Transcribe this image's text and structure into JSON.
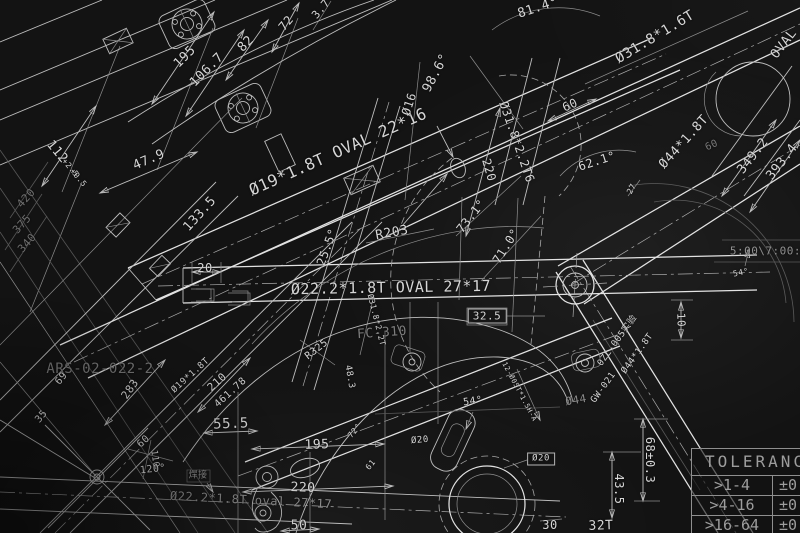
{
  "colors": {
    "background": "#131313",
    "line": "#bdbdbd",
    "line_bright": "#e2e2e2",
    "line_faint": "#575757",
    "text": "#d6d6d6",
    "text_faint": "#8d8d8d"
  },
  "table": {
    "header": "TOLERANCE",
    "rows": [
      {
        "range": ">1-4",
        "value": "±0"
      },
      {
        "range": ">4-16",
        "value": "±0"
      },
      {
        "range": ">16-64",
        "value": "±0"
      }
    ]
  },
  "drawing": {
    "labels": [
      {
        "name": "dim-label",
        "text": "195",
        "x": 185,
        "y": 57,
        "rot": -45,
        "size": 13
      },
      {
        "name": "dim-label",
        "text": "106.7",
        "x": 207,
        "y": 70,
        "rot": -45,
        "size": 13
      },
      {
        "name": "dim-label",
        "text": "82",
        "x": 246,
        "y": 44,
        "rot": -45,
        "size": 13
      },
      {
        "name": "dim-label",
        "text": "112",
        "x": 57,
        "y": 152,
        "rot": 50,
        "size": 13
      },
      {
        "name": "tolerance-label",
        "text": "+2.5",
        "x": 70,
        "y": 168,
        "rot": 50,
        "size": 8
      },
      {
        "name": "tolerance-label",
        "text": "+0.5",
        "x": 78,
        "y": 178,
        "rot": 50,
        "size": 8
      },
      {
        "name": "dim-label",
        "text": "47.9",
        "x": 149,
        "y": 160,
        "rot": -23,
        "size": 13
      },
      {
        "name": "dim-label",
        "text": "72",
        "x": 286,
        "y": 23,
        "rot": -50,
        "size": 12
      },
      {
        "name": "dim-label",
        "text": "3.7",
        "x": 321,
        "y": 9,
        "rot": -50,
        "size": 11
      },
      {
        "name": "dim-label",
        "text": "420",
        "x": 26,
        "y": 198,
        "rot": -48,
        "size": 11,
        "color": "#6e6e6e"
      },
      {
        "name": "dim-label",
        "text": "375",
        "x": 22,
        "y": 224,
        "rot": -48,
        "size": 11,
        "color": "#6e6e6e"
      },
      {
        "name": "dim-label",
        "text": "340",
        "x": 27,
        "y": 243,
        "rot": -48,
        "size": 11,
        "color": "#6e6e6e"
      },
      {
        "name": "dim-label",
        "text": "133.5",
        "x": 200,
        "y": 214,
        "rot": -48,
        "size": 13
      },
      {
        "name": "dim-label",
        "text": "20",
        "x": 205,
        "y": 268,
        "rot": 0,
        "size": 12
      },
      {
        "name": "tube-spec-label",
        "text": "Ø19*1.8T OVAL 22*16",
        "x": 338,
        "y": 152,
        "rot": -24,
        "size": 16
      },
      {
        "name": "dim-label",
        "text": "Ø16",
        "x": 409,
        "y": 104,
        "rot": -72,
        "size": 12
      },
      {
        "name": "angle-label",
        "text": "98.6°",
        "x": 436,
        "y": 73,
        "rot": -62,
        "size": 13
      },
      {
        "name": "tube-spec-label",
        "text": "Ø31.8*2.2T6",
        "x": 517,
        "y": 142,
        "rot": 71,
        "size": 12
      },
      {
        "name": "dim-label",
        "text": "220",
        "x": 489,
        "y": 170,
        "rot": 74,
        "size": 12
      },
      {
        "name": "angle-label",
        "text": "81.4°",
        "x": 538,
        "y": 8,
        "rot": -18,
        "size": 13
      },
      {
        "name": "tube-spec-label",
        "text": "Ø31.8*1.6T",
        "x": 655,
        "y": 37,
        "rot": -31,
        "size": 14
      },
      {
        "name": "tube-spec-label",
        "text": "OVAL",
        "x": 784,
        "y": 44,
        "rot": -52,
        "size": 13
      },
      {
        "name": "dim-label",
        "text": "60",
        "x": 570,
        "y": 105,
        "rot": -24,
        "size": 12
      },
      {
        "name": "dim-label",
        "text": "60",
        "x": 712,
        "y": 146,
        "rot": -24,
        "size": 10,
        "color": "#777777"
      },
      {
        "name": "angle-label",
        "text": "62.1°",
        "x": 597,
        "y": 161,
        "rot": -18,
        "size": 12
      },
      {
        "name": "tube-spec-label",
        "text": "Ø44*1.8T",
        "x": 684,
        "y": 142,
        "rot": -48,
        "size": 13
      },
      {
        "name": "dim-label",
        "text": "349.2",
        "x": 753,
        "y": 156,
        "rot": -52,
        "size": 13
      },
      {
        "name": "dim-label",
        "text": "393.4",
        "x": 782,
        "y": 162,
        "rot": -52,
        "size": 13
      },
      {
        "name": "angle-label",
        "text": "25.5°",
        "x": 327,
        "y": 247,
        "rot": -70,
        "size": 12
      },
      {
        "name": "radius-label",
        "text": "R203",
        "x": 392,
        "y": 233,
        "rot": -10,
        "size": 13
      },
      {
        "name": "angle-label",
        "text": "73.1°",
        "x": 471,
        "y": 216,
        "rot": -52,
        "size": 12
      },
      {
        "name": "angle-label",
        "text": "71.0°",
        "x": 506,
        "y": 246,
        "rot": -58,
        "size": 12
      },
      {
        "name": "tube-spec-label",
        "text": "Ø22.2*1.8T OVAL 27*17",
        "x": 391,
        "y": 288,
        "rot": -1,
        "size": 15
      },
      {
        "name": "dim-label",
        "text": "32.5",
        "x": 487,
        "y": 316,
        "rot": 0,
        "size": 11,
        "boxed": true
      },
      {
        "name": "part-number-label",
        "text": "FC-310",
        "x": 382,
        "y": 333,
        "rot": -4,
        "size": 13,
        "color": "#7d7d7d"
      },
      {
        "name": "tube-spec-label",
        "text": "Ø31.8*2.2T",
        "x": 376,
        "y": 320,
        "rot": 76,
        "size": 8
      },
      {
        "name": "radius-label",
        "text": "R325",
        "x": 317,
        "y": 350,
        "rot": -38,
        "size": 10
      },
      {
        "name": "note-label",
        "text": "5:00\\7:00:2",
        "x": 769,
        "y": 251,
        "rot": 0,
        "size": 11,
        "color": "#8d8d8d"
      },
      {
        "name": "part-number-label",
        "text": "ARS-02-022-2",
        "x": 100,
        "y": 369,
        "rot": 0,
        "size": 14,
        "color": "#757575"
      },
      {
        "name": "dim-label",
        "text": "69",
        "x": 62,
        "y": 379,
        "rot": -50,
        "size": 10
      },
      {
        "name": "dim-label",
        "text": "35",
        "x": 42,
        "y": 417,
        "rot": -50,
        "size": 10
      },
      {
        "name": "dim-label",
        "text": "283",
        "x": 130,
        "y": 389,
        "rot": -55,
        "size": 11
      },
      {
        "name": "tube-spec-label",
        "text": "Ø19*1.8T",
        "x": 191,
        "y": 376,
        "rot": -42,
        "size": 9
      },
      {
        "name": "dim-label",
        "text": "210",
        "x": 217,
        "y": 382,
        "rot": -42,
        "size": 11
      },
      {
        "name": "dim-label",
        "text": "461.78",
        "x": 231,
        "y": 393,
        "rot": -42,
        "size": 10
      },
      {
        "name": "dim-label",
        "text": "55.5",
        "x": 231,
        "y": 424,
        "rot": -2,
        "size": 14
      },
      {
        "name": "dim-label",
        "text": "60",
        "x": 144,
        "y": 442,
        "rot": -42,
        "size": 10
      },
      {
        "name": "dim-label",
        "text": "110",
        "x": 154,
        "y": 459,
        "rot": 82,
        "size": 9
      },
      {
        "name": "angle-label",
        "text": "120°",
        "x": 153,
        "y": 470,
        "rot": -6,
        "size": 10
      },
      {
        "name": "weld-note-label",
        "text": "焊接",
        "x": 198,
        "y": 476,
        "rot": 0,
        "size": 9,
        "color": "#8d8d8d"
      },
      {
        "name": "tube-spec-label",
        "text": "Ø22.2*1.8T oval 27*17",
        "x": 251,
        "y": 500,
        "rot": 3,
        "size": 12,
        "color": "#888888"
      },
      {
        "name": "dim-label",
        "text": "220",
        "x": 303,
        "y": 488,
        "rot": 2,
        "size": 13
      },
      {
        "name": "dim-label",
        "text": "50",
        "x": 299,
        "y": 526,
        "rot": 0,
        "size": 13
      },
      {
        "name": "dim-label",
        "text": "195",
        "x": 317,
        "y": 445,
        "rot": -2,
        "size": 13
      },
      {
        "name": "dim-label",
        "text": "48.3",
        "x": 349,
        "y": 377,
        "rot": 80,
        "size": 9
      },
      {
        "name": "angle-label",
        "text": "72°",
        "x": 355,
        "y": 431,
        "rot": -50,
        "size": 8
      },
      {
        "name": "dim-label",
        "text": "61",
        "x": 371,
        "y": 465,
        "rot": -50,
        "size": 8
      },
      {
        "name": "dim-label",
        "text": "Ø20",
        "x": 420,
        "y": 441,
        "rot": -5,
        "size": 9
      },
      {
        "name": "angle-label",
        "text": "54°",
        "x": 473,
        "y": 402,
        "rot": -8,
        "size": 10
      },
      {
        "name": "note-label",
        "text": "12-Ø05T*1.5H-A",
        "x": 519,
        "y": 392,
        "rot": 62,
        "size": 7
      },
      {
        "name": "dim-label",
        "text": "Ø20",
        "x": 541,
        "y": 459,
        "rot": 0,
        "size": 9,
        "boxed": true
      },
      {
        "name": "dim-label",
        "text": "30",
        "x": 550,
        "y": 525,
        "rot": 0,
        "size": 12
      },
      {
        "name": "angle-label",
        "text": "54°",
        "x": 741,
        "y": 273,
        "rot": -12,
        "size": 8
      },
      {
        "name": "dim-label",
        "text": "10",
        "x": 681,
        "y": 320,
        "rot": 88,
        "size": 11
      },
      {
        "name": "dim-label",
        "text": "27",
        "x": 632,
        "y": 189,
        "rot": -62,
        "size": 8
      },
      {
        "name": "part-number-label",
        "text": "0ZL-005实验",
        "x": 618,
        "y": 341,
        "rot": -54,
        "size": 9
      },
      {
        "name": "tube-spec-label",
        "text": "Ø44*1.8T",
        "x": 638,
        "y": 354,
        "rot": -54,
        "size": 9
      },
      {
        "name": "part-number-label",
        "text": "GW-021",
        "x": 604,
        "y": 388,
        "rot": -54,
        "size": 9
      },
      {
        "name": "dim-label",
        "text": "Ø44",
        "x": 576,
        "y": 400,
        "rot": -10,
        "size": 11,
        "color": "#8a8a8a"
      },
      {
        "name": "dim-label",
        "text": "68±0.3",
        "x": 650,
        "y": 460,
        "rot": 90,
        "size": 12
      },
      {
        "name": "dim-label",
        "text": "43.5",
        "x": 619,
        "y": 489,
        "rot": 90,
        "size": 12
      },
      {
        "name": "gear-label",
        "text": "32T",
        "x": 601,
        "y": 526,
        "rot": -2,
        "size": 13
      }
    ]
  }
}
